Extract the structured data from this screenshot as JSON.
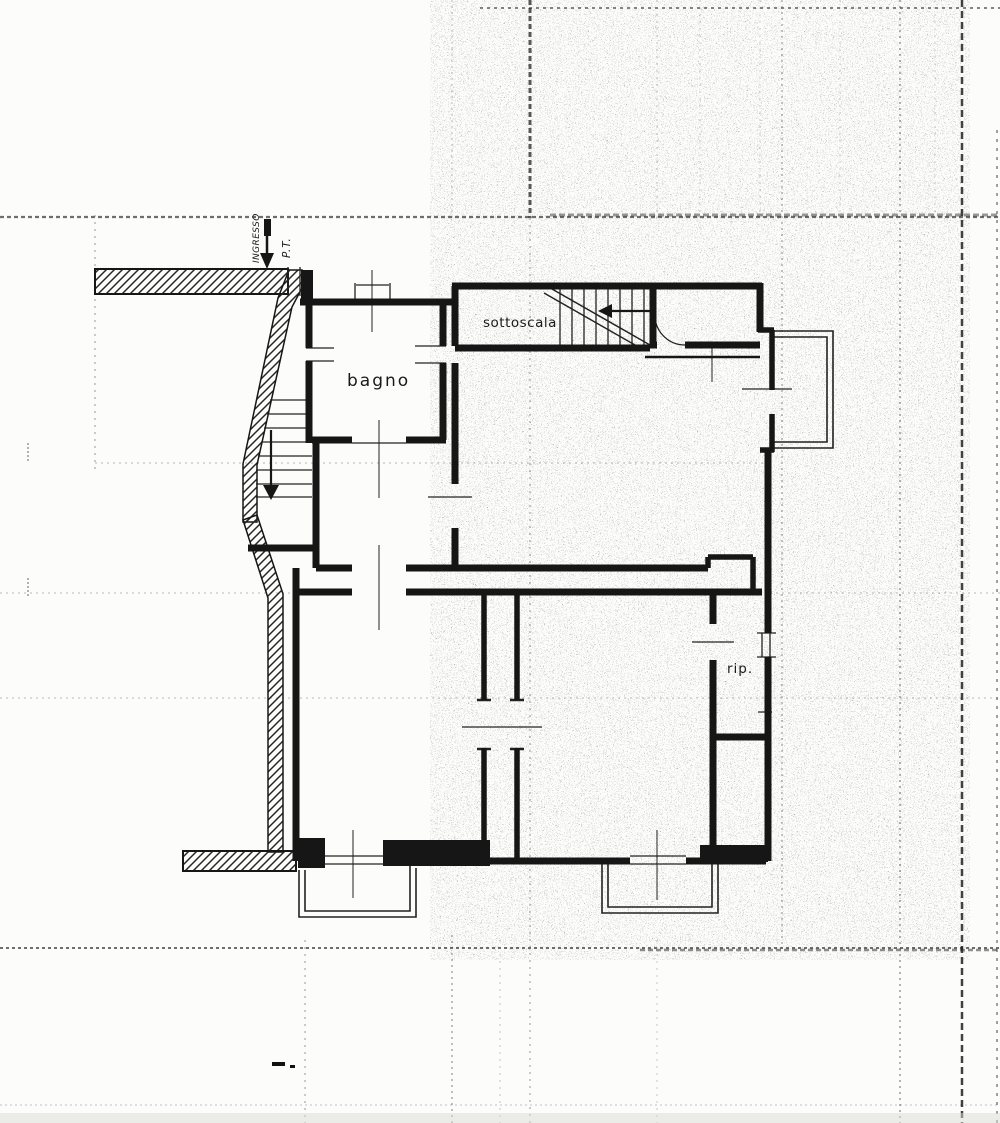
{
  "document": {
    "kind_label": "scanned floor plan",
    "colors": {
      "paper": "#fcfcfa",
      "ink": "#161616"
    },
    "plan": {
      "labels": {
        "entrance": "INGRESSO",
        "floor_level": "P.T.",
        "bathroom": "bagno",
        "under_stairs": "sottoscala",
        "closet": "rip."
      }
    }
  }
}
